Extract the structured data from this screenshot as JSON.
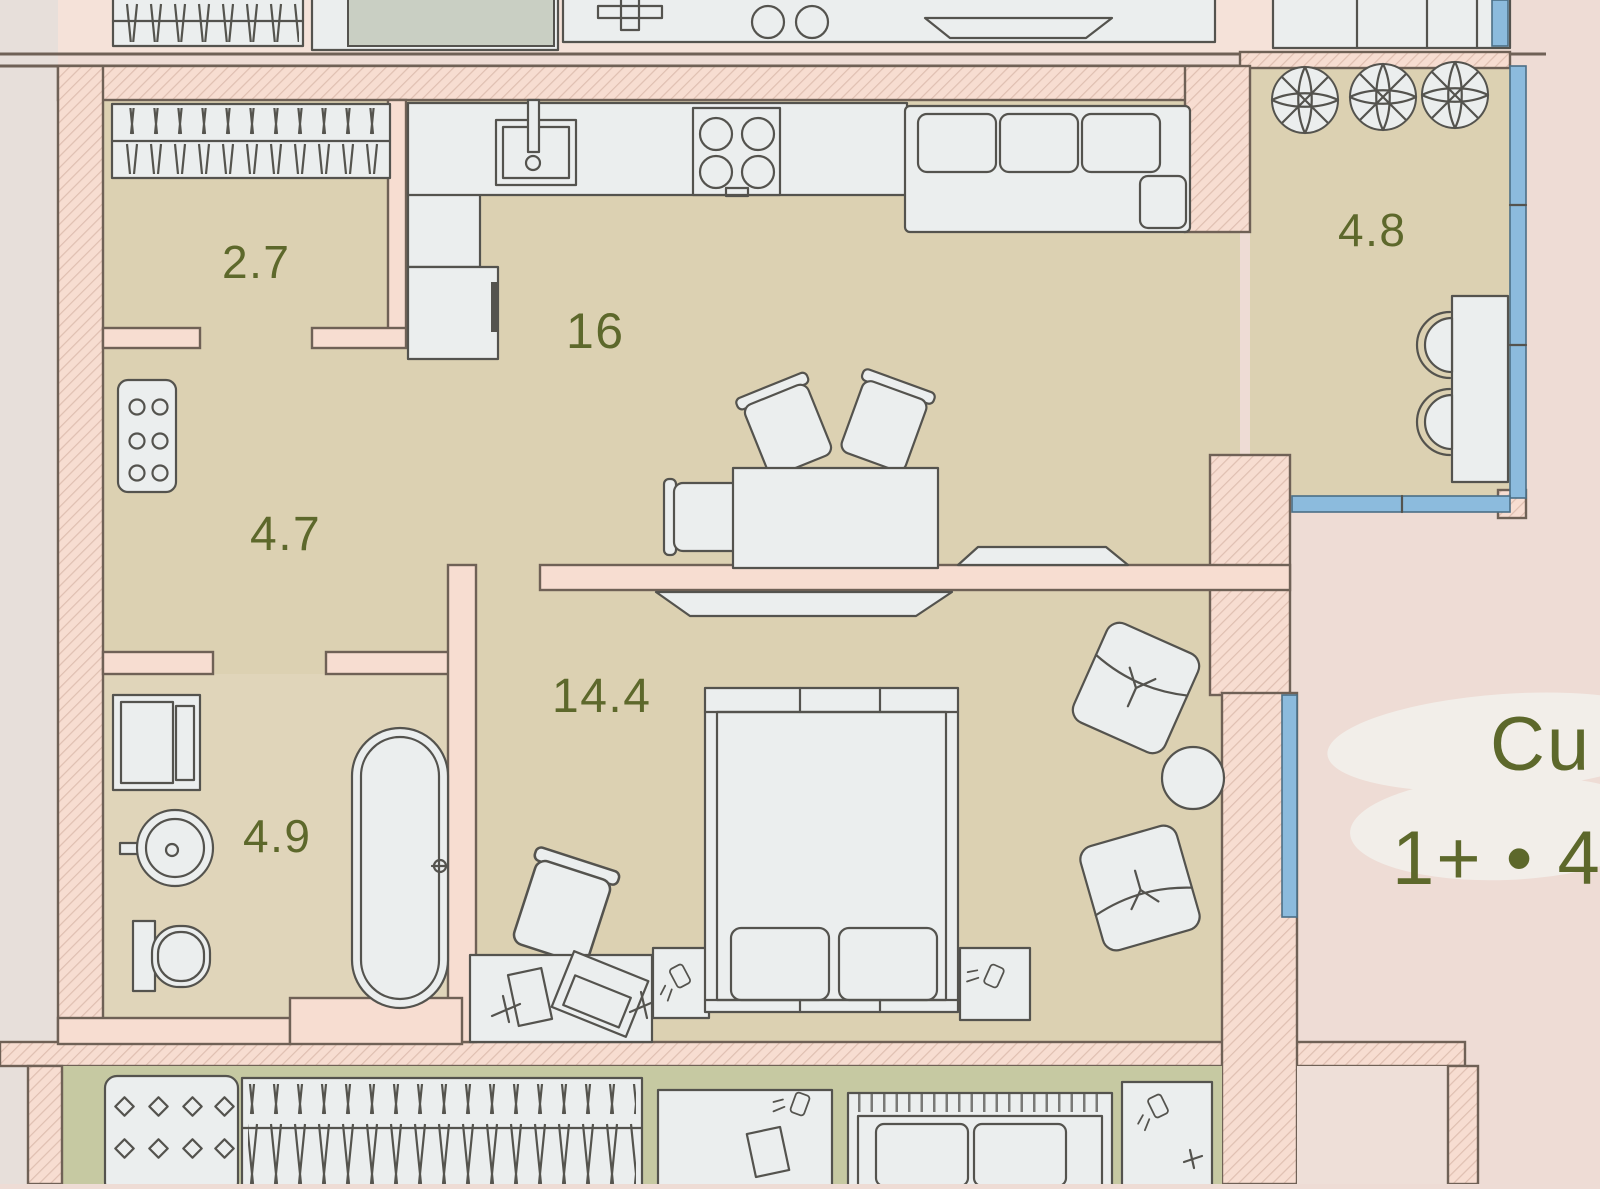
{
  "document_type": "apartment floor plan (scanned brochure photo)",
  "labels": {
    "wardrobe": "2.7",
    "kitchen_living": "16",
    "hallway": "4.7",
    "bathroom": "4.9",
    "bedroom": "14.4",
    "balcony": "4.8"
  },
  "annotation": {
    "line1": "Cu",
    "line2": "1+ • 4"
  },
  "colors": {
    "page": "#eedcd5",
    "page_strip": "#e7dfda",
    "upper_floor": "#f5e2d9",
    "wall": "#f7ddd1",
    "wall_line": "#6f6156",
    "floor": "#dcd1b2",
    "floor_bath": "#e0d5ba",
    "floor_lower": "#c6c9a2",
    "floor_neighbor": "#eedfd8",
    "furniture": "#ebeeee",
    "furniture_line": "#54534e",
    "window_glass": "#8cbbdd",
    "window_line": "#4c6f86",
    "label_text": "#5d682b",
    "wash": "#f2eee9",
    "upper_bed_fill": "#c9cfc3"
  }
}
